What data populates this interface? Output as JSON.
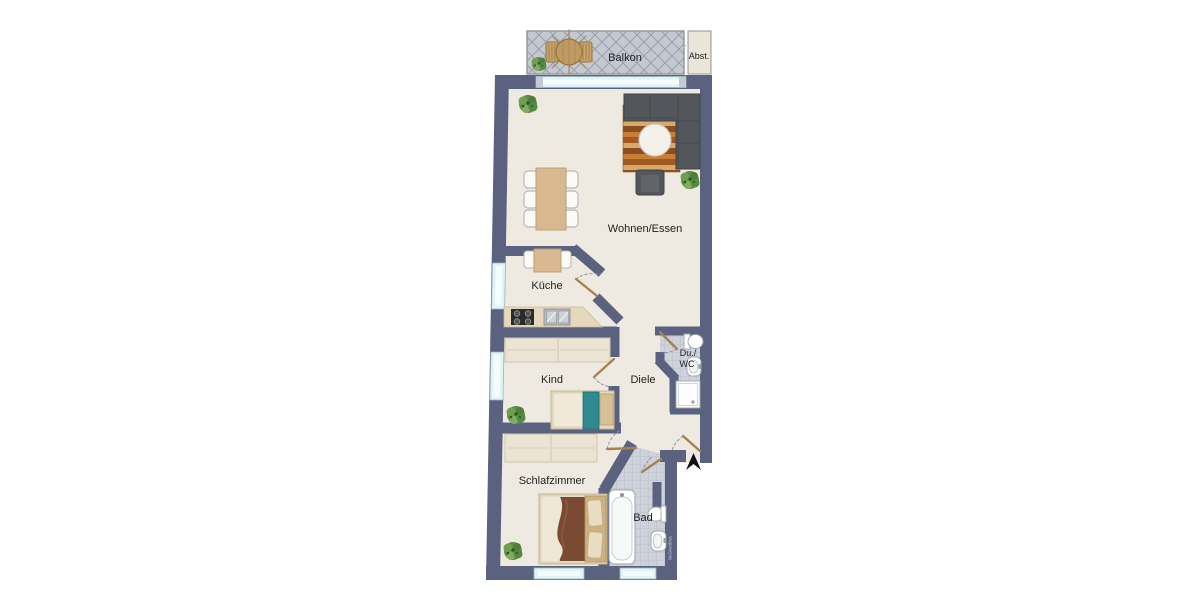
{
  "rooms": {
    "balkon": {
      "label": "Balkon"
    },
    "abstellraum": {
      "label": "Abst."
    },
    "wohnen_essen": {
      "label": "Wohnen/Essen"
    },
    "kueche": {
      "label": "Küche"
    },
    "kind": {
      "label": "Kind"
    },
    "diele": {
      "label": "Diele"
    },
    "du_wc": {
      "label_line1": "Du./",
      "label_line2": "WC"
    },
    "schlafzimmer": {
      "label": "Schlafzimmer"
    },
    "bad": {
      "label": "Bad"
    }
  },
  "watermark": {
    "text": "McGrundriss"
  },
  "colors": {
    "wall": "#5a6280",
    "floor": "#efeae1",
    "tile": "#ced2da",
    "tile_line": "#b7bbc5",
    "balcony": "#c4c8d0",
    "balcony_hatch": "#9aa0ab",
    "window": "#dff4f6",
    "wood": "#d7b88f",
    "counter": "#e6d8bd",
    "door_leaf": "#a5834f",
    "swing_arc": "#8e939c",
    "sofa": "#53575c",
    "blanket_kind": "#2e8a8f",
    "blanket_schlaf": "#7a4a33",
    "plant": "#5d8f46",
    "entry_arrow": "#111111"
  }
}
